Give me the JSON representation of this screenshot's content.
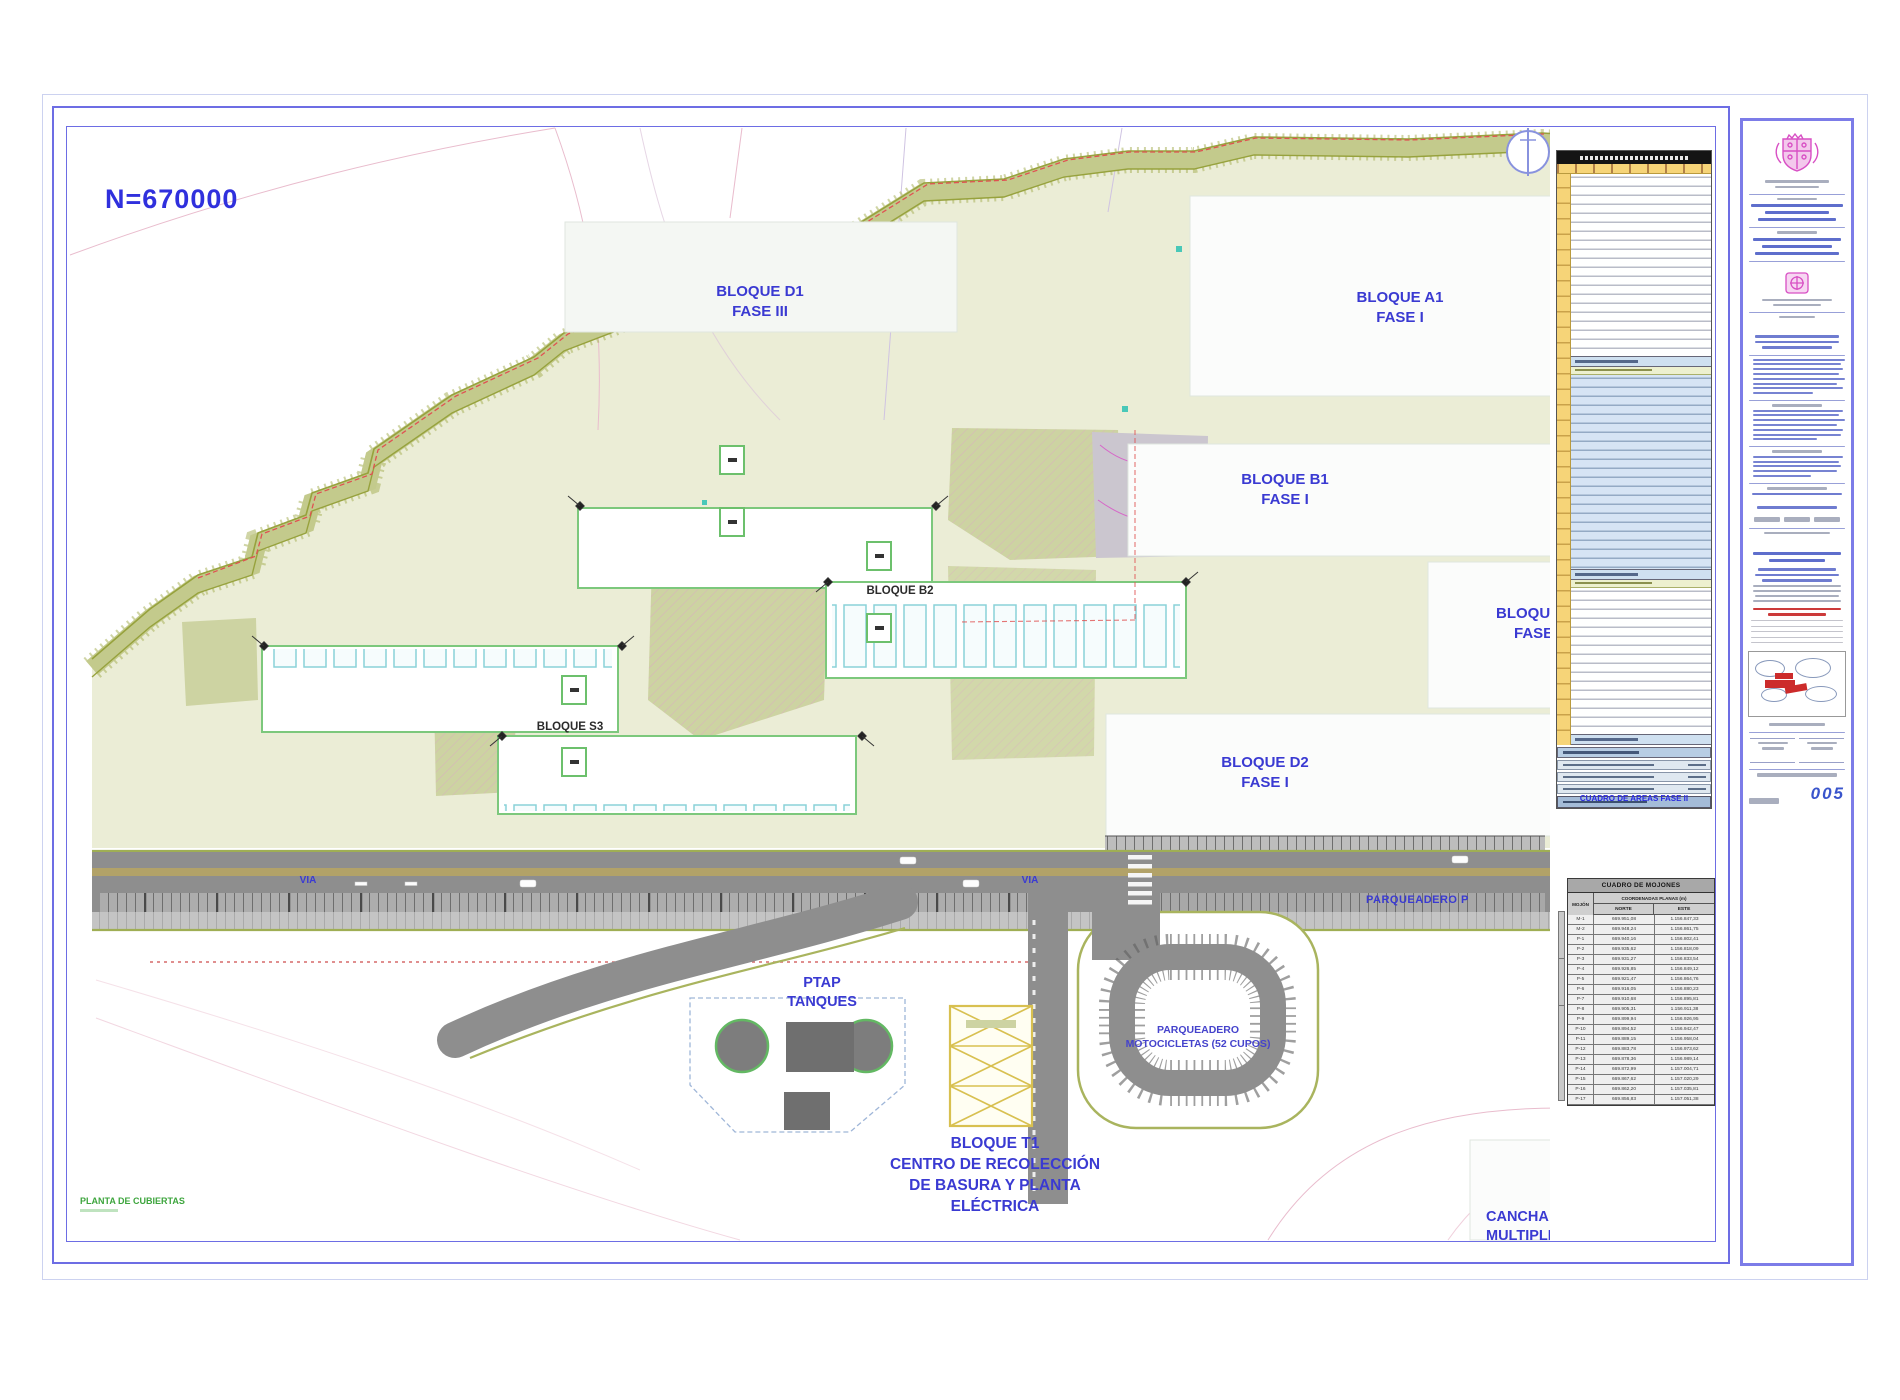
{
  "colors": {
    "label_blue": "#3a3ad2",
    "terrain_olive": "#c9cf9b",
    "road_gray": "#8e8e8e",
    "fase_band_yellow": "#f6d478",
    "crest_magenta": "#d84fc4",
    "stamp_red": "#cc3a3a",
    "frame_blue": "#6d6de4"
  },
  "sheet": {
    "coordinate_label": "N=670000",
    "sheet_number": "005",
    "plan_title": "PLANTA DE CUBIERTAS"
  },
  "plan": {
    "blocks": {
      "d1": {
        "line1": "BLOQUE D1",
        "line2": "FASE III"
      },
      "a1": {
        "line1": "BLOQUE A1",
        "line2": "FASE I"
      },
      "b1": {
        "line1": "BLOQUE B1",
        "line2": "FASE I"
      },
      "d2": {
        "line1": "BLOQUE D2",
        "line2": "FASE I"
      },
      "b2": {
        "label": "BLOQUE B2"
      },
      "s3": {
        "label": "BLOQUE S3"
      },
      "edge": {
        "line1": "BLOQUE",
        "line2": "FASE"
      },
      "t1": {
        "line1": "BLOQUE T1",
        "line2": "CENTRO DE RECOLECCIÓN",
        "line3": "DE BASURA Y PLANTA",
        "line4": "ELÉCTRICA"
      },
      "cancha": {
        "line1": "CANCHA",
        "line2": "MULTIPLE"
      }
    },
    "roads": {
      "via_left": "VIA",
      "via_right": "VIA",
      "parqueadero": "PARQUEADERO P"
    },
    "ptap": {
      "line1": "PTAP",
      "line2": "TANQUES"
    },
    "moto": {
      "line1": "PARQUEADERO",
      "line2": "MOTOCICLETAS (52 CUPOS)"
    }
  },
  "areas_table": {
    "caption": "CUADRO DE AREAS FASE II"
  },
  "mojones_table": {
    "title": "CUADRO DE MOJONES",
    "col_mojon": "MOJÓN",
    "col_coords": "COORDENADAS PLANAS (m)",
    "col_norte": "NORTE",
    "col_este": "ESTE",
    "rows": [
      {
        "id": "M-1",
        "norte": "669.951,08",
        "este": "1.156.847,33"
      },
      {
        "id": "M-2",
        "norte": "669.948,24",
        "este": "1.156.861,75"
      },
      {
        "id": "P-1",
        "norte": "669.940,16",
        "este": "1.156.802,41"
      },
      {
        "id": "P-2",
        "norte": "669.935,62",
        "este": "1.156.818,09"
      },
      {
        "id": "P-3",
        "norte": "669.931,27",
        "este": "1.156.833,54"
      },
      {
        "id": "P-4",
        "norte": "669.926,85",
        "este": "1.156.849,12"
      },
      {
        "id": "P-5",
        "norte": "669.921,47",
        "este": "1.156.864,76"
      },
      {
        "id": "P-6",
        "norte": "669.916,05",
        "este": "1.156.880,23"
      },
      {
        "id": "P-7",
        "norte": "669.910,68",
        "este": "1.156.895,81"
      },
      {
        "id": "P-8",
        "norte": "669.905,31",
        "este": "1.156.911,38"
      },
      {
        "id": "P-9",
        "norte": "669.899,94",
        "este": "1.156.926,95"
      },
      {
        "id": "P-10",
        "norte": "669.894,52",
        "este": "1.156.942,47"
      },
      {
        "id": "P-11",
        "norte": "669.889,15",
        "este": "1.156.958,04"
      },
      {
        "id": "P-12",
        "norte": "669.883,78",
        "este": "1.156.973,62"
      },
      {
        "id": "P-13",
        "norte": "669.878,36",
        "este": "1.156.989,14"
      },
      {
        "id": "P-14",
        "norte": "669.872,99",
        "este": "1.157.004,71"
      },
      {
        "id": "P-15",
        "norte": "669.867,62",
        "este": "1.157.020,29"
      },
      {
        "id": "P-16",
        "norte": "669.862,20",
        "este": "1.157.035,81"
      },
      {
        "id": "P-17",
        "norte": "669.856,83",
        "este": "1.157.051,38"
      }
    ]
  }
}
